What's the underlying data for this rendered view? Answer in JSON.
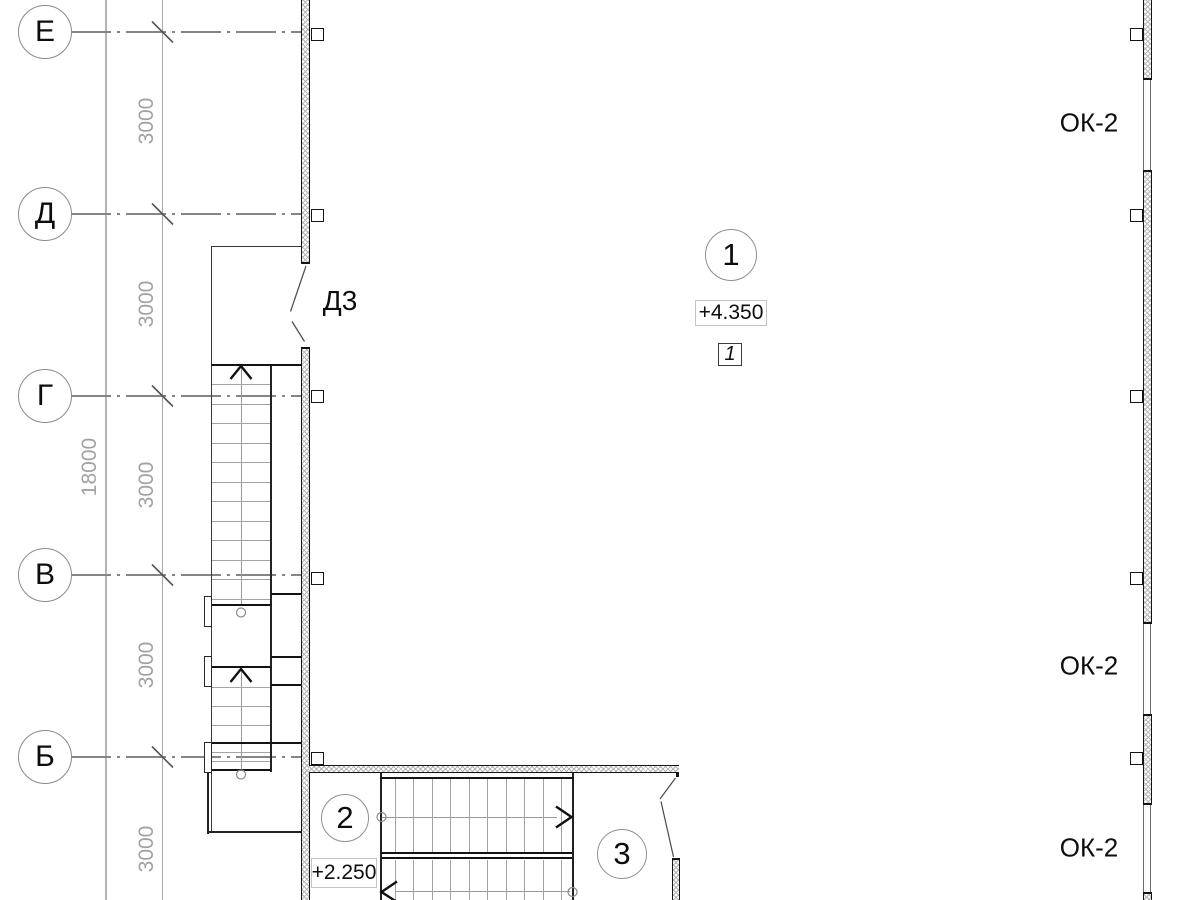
{
  "colors": {
    "line": "#141414",
    "grid_line": "#858585",
    "dimension_text": "#a2a2a2",
    "wall_hatch": "#b5b5b5"
  },
  "grid": {
    "axes": [
      {
        "label": "Е"
      },
      {
        "label": "Д"
      },
      {
        "label": "Г"
      },
      {
        "label": "В"
      },
      {
        "label": "Б"
      }
    ],
    "bay_dimensions": [
      {
        "text": "3000"
      },
      {
        "text": "3000"
      },
      {
        "text": "3000"
      },
      {
        "text": "3000"
      },
      {
        "text": "3000"
      }
    ],
    "total_dimension": {
      "text": "18000"
    }
  },
  "annotations": {
    "door_tag": "Д3",
    "window_tags": [
      {
        "text": "ОК-2"
      },
      {
        "text": "ОК-2"
      },
      {
        "text": "ОК-2"
      }
    ],
    "balloon_axis": "1",
    "balloon_stair": "2",
    "balloon_room": "3",
    "level_upper": "+4.350",
    "level_lower": "+2.250",
    "detail_marker": "1"
  }
}
